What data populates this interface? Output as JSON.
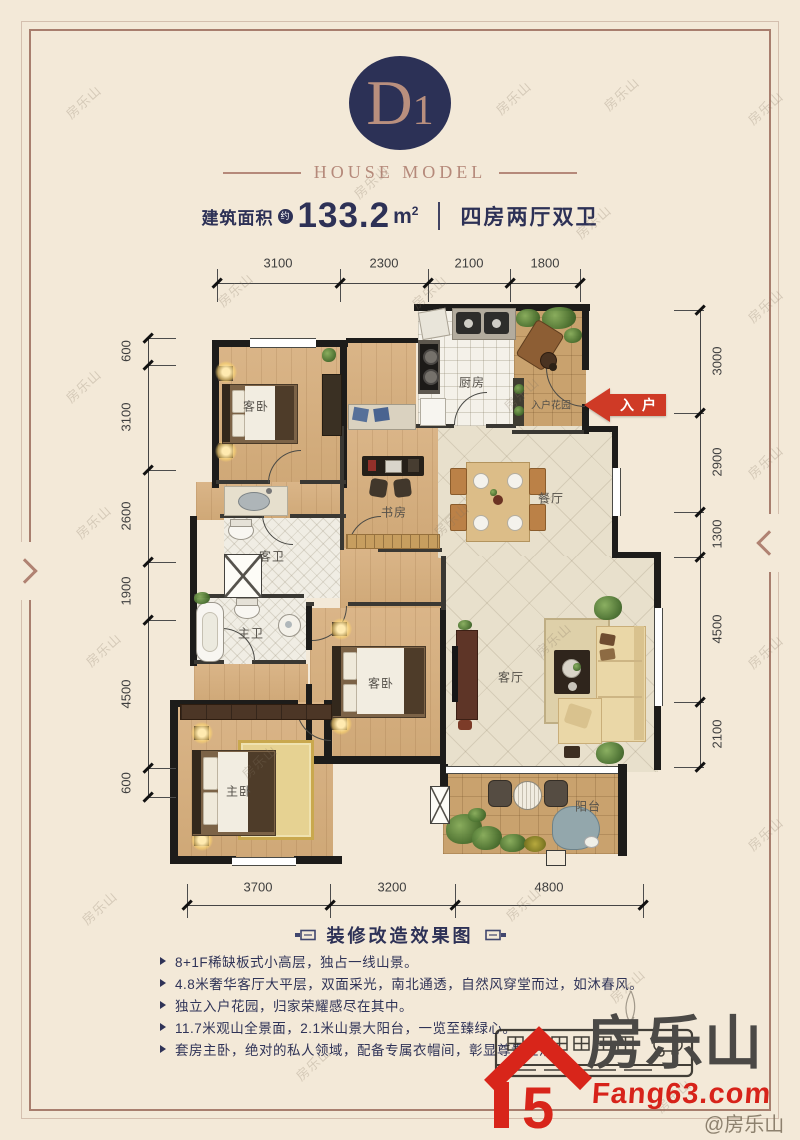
{
  "header": {
    "model_code_main": "D",
    "model_code_sub": "1",
    "subtitle": "HOUSE MODEL",
    "area_label": "建筑面积",
    "area_approx_badge": "约",
    "area_value": "133.2",
    "area_unit": "m",
    "area_unit_sup": "2",
    "layout_text": "四房两厅双卫"
  },
  "floorplan": {
    "entry_arrow_label": "入户",
    "rooms": [
      {
        "id": "bedroom-1",
        "label": "客卧"
      },
      {
        "id": "kitchen",
        "label": "厨房"
      },
      {
        "id": "entry-garden",
        "label": "入户花园"
      },
      {
        "id": "study",
        "label": "书房"
      },
      {
        "id": "dining-room",
        "label": "餐厅"
      },
      {
        "id": "guest-bath",
        "label": "客卫"
      },
      {
        "id": "master-bath",
        "label": "主卫"
      },
      {
        "id": "bedroom-2",
        "label": "客卧"
      },
      {
        "id": "living-room",
        "label": "客厅"
      },
      {
        "id": "master-bedroom",
        "label": "主卧"
      },
      {
        "id": "balcony",
        "label": "阳台"
      }
    ],
    "dimensions": {
      "top": [
        "3100",
        "2300",
        "2100",
        "1800"
      ],
      "bottom": [
        "3700",
        "3200",
        "4800"
      ],
      "left": [
        "600",
        "3100",
        "2600",
        "1900",
        "4500",
        "600"
      ],
      "right": [
        "3000",
        "2900",
        "1300",
        "4500",
        "2100"
      ]
    }
  },
  "caption": {
    "text": "装修改造效果图"
  },
  "features": [
    "8+1F稀缺板式小高层，独占一线山景。",
    "4.8米奢华客厅大平层，双面采光，南北通透，自然风穿堂而过，如沐春风。",
    "独立入户花园，归家荣耀感尽在其中。",
    "11.7米观山全景面，2.1米山景大阳台，一览至臻绿心。",
    "套房主卧，绝对的私人领域，配备专属衣帽间，彰显尊贵生活。"
  ],
  "branding": {
    "name": "房乐山",
    "house_numeral": "5",
    "site": "Fang63.com",
    "credit": "@房乐山"
  },
  "watermark": "房乐山",
  "colors": {
    "background": "#f3e9d8",
    "navy": "#2d3156",
    "rose": "#b5897a",
    "arrow_red": "#cf3a26",
    "logo_red": "#d8251a",
    "logo_gray": "#4b4946"
  }
}
